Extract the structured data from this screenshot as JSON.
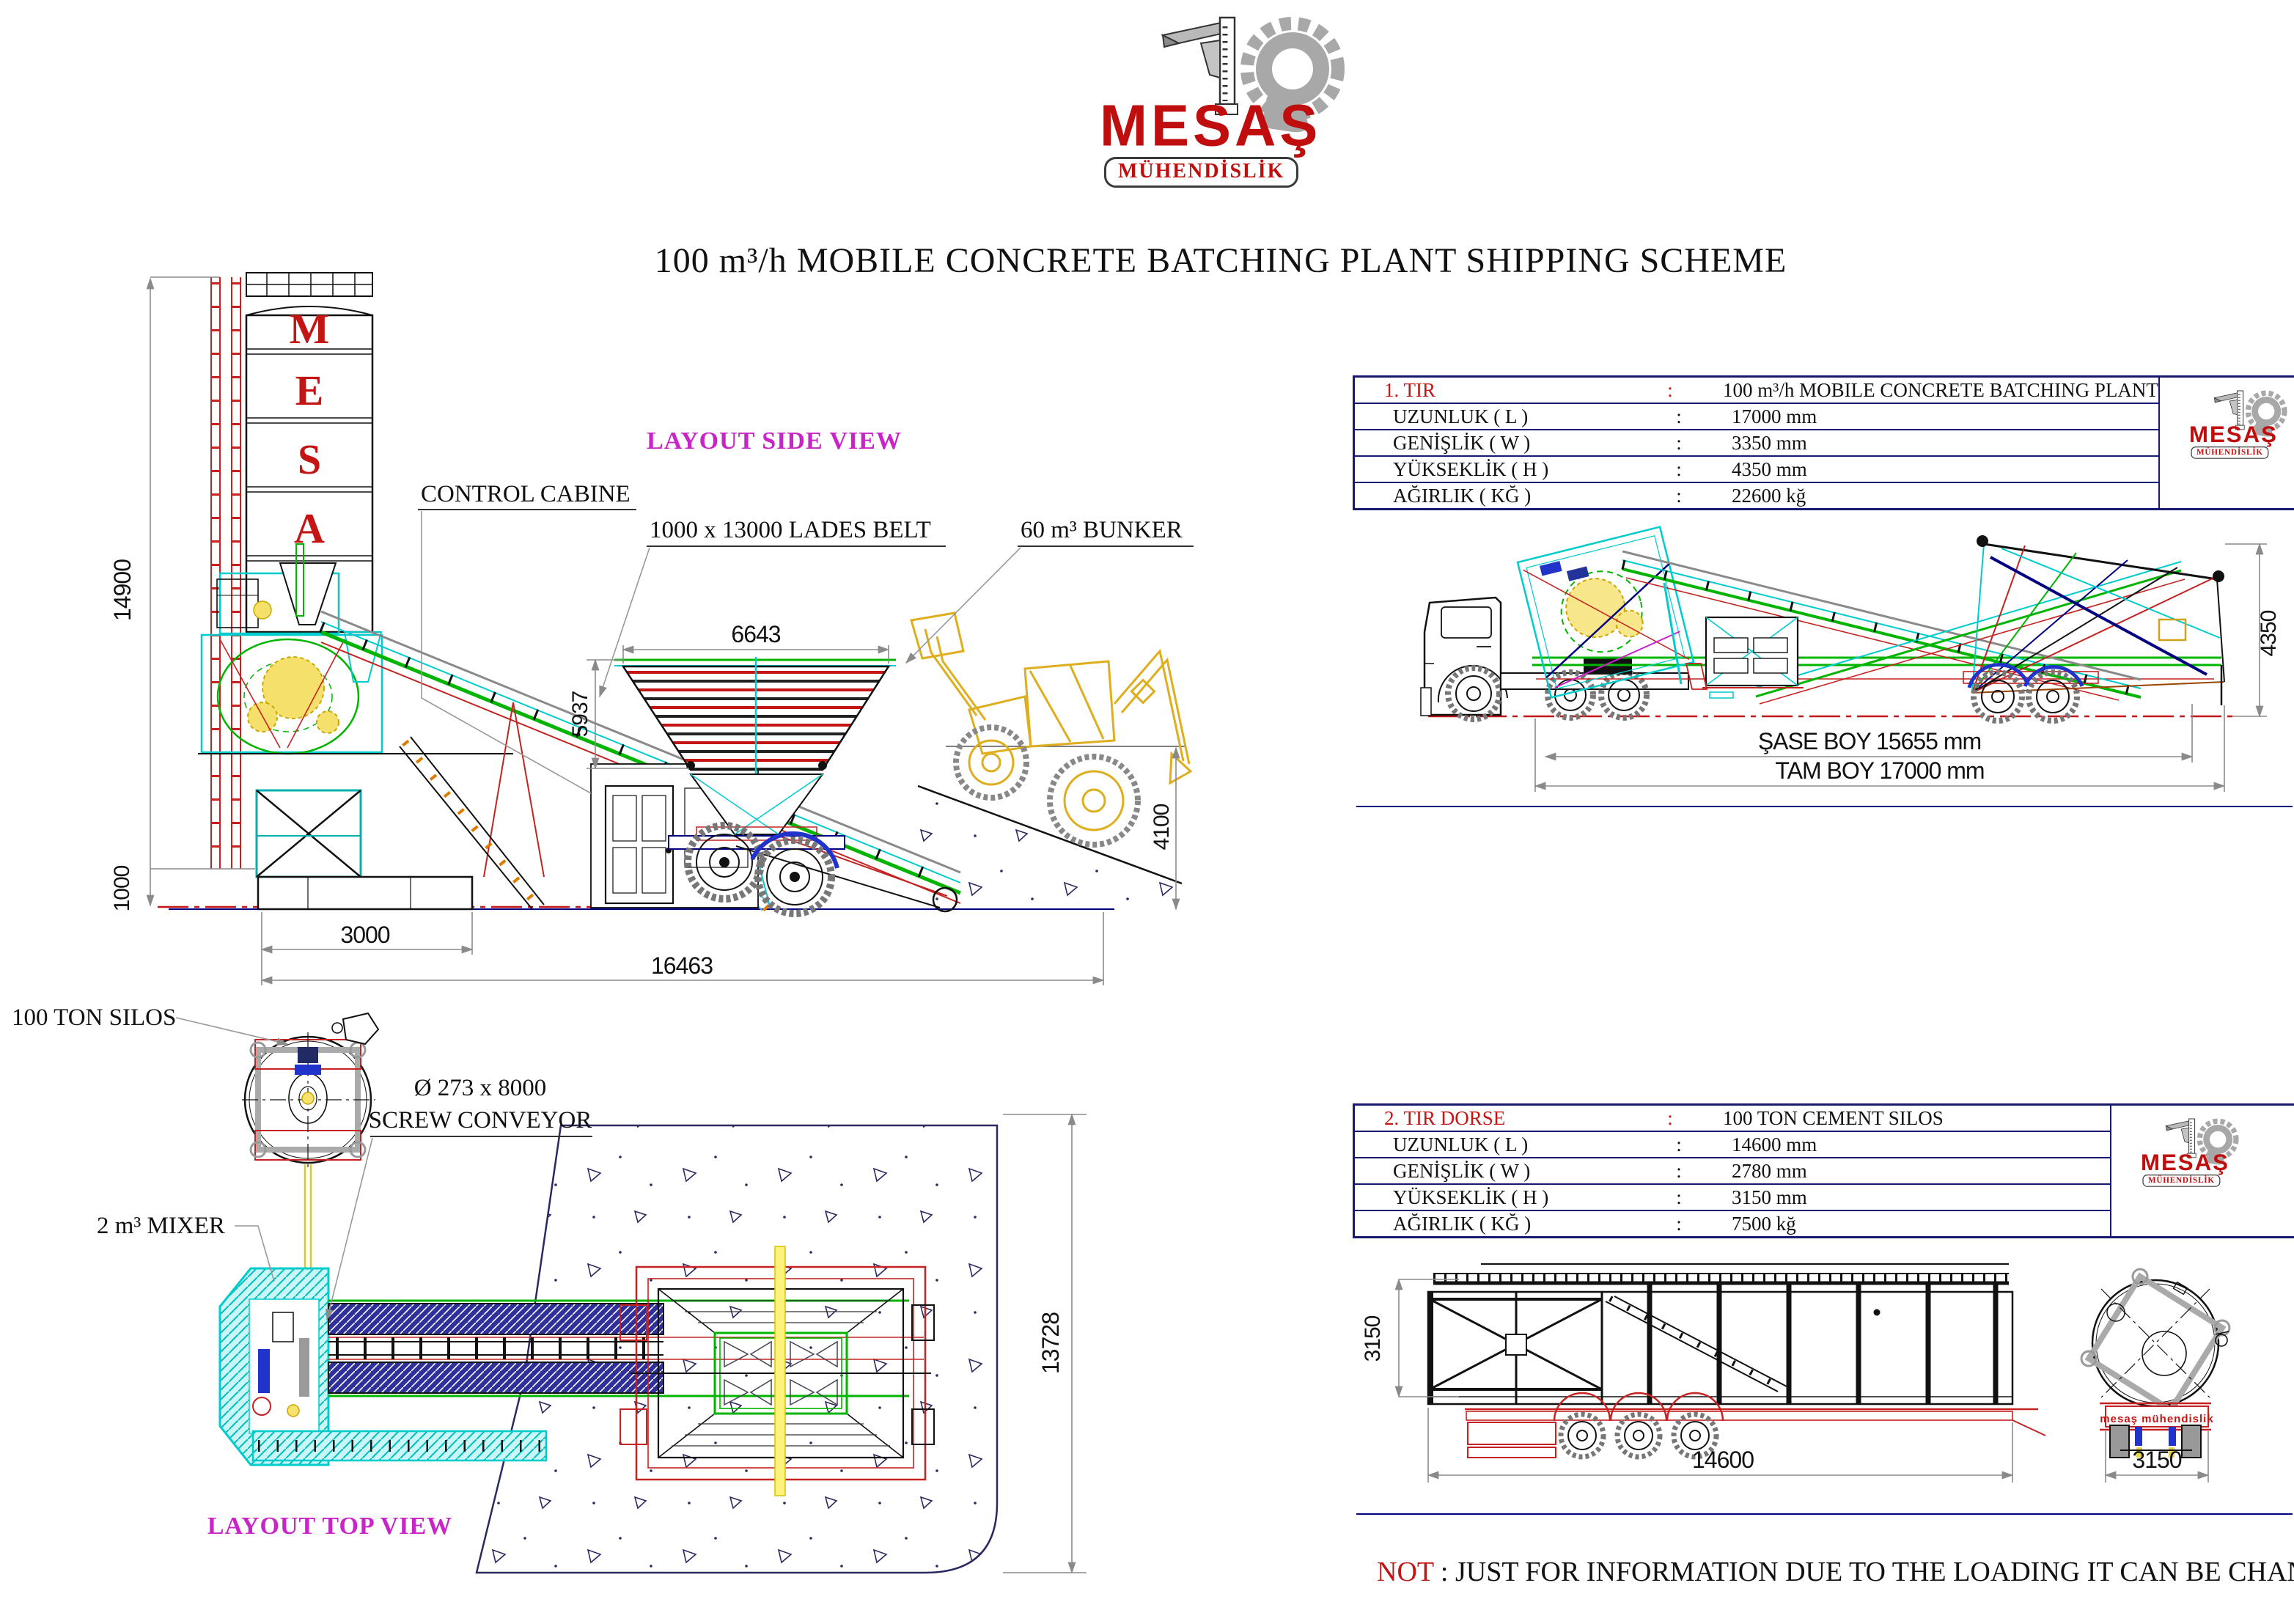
{
  "logo": {
    "brand": "MESAŞ",
    "subtitle": "MÜHENDİSLİK"
  },
  "title": "100 m³/h MOBILE CONCRETE BATCHING PLANT SHIPPING SCHEME",
  "side_view": {
    "caption": "LAYOUT SIDE VIEW",
    "silo_letters": [
      "M",
      "E",
      "S",
      "A",
      "Ş"
    ],
    "labels": {
      "control_cabin": "CONTROL CABINE",
      "lades_belt": "1000 x 13000 LADES BELT",
      "bunker": "60 m³ BUNKER"
    },
    "dims": {
      "total_height": "14900",
      "base_height": "1000",
      "base_width": "3000",
      "total_length": "16463",
      "bunker_width": "6643",
      "bunker_height": "5937",
      "ramp_height": "4100"
    }
  },
  "top_view": {
    "caption": "LAYOUT TOP VIEW",
    "labels": {
      "silos": "100 TON SILOS",
      "screw_line1": "Ø 273 x 8000",
      "screw_line2": "SCREW CONVEYOR",
      "mixer": "2 m³ MIXER"
    },
    "dims": {
      "pad_length": "13728"
    }
  },
  "truck1": {
    "table": {
      "rows": [
        {
          "label": "1. TIR",
          "colon": ":",
          "value": "100 m³/h MOBILE CONCRETE BATCHING PLANT"
        },
        {
          "label": "UZUNLUK ( L )",
          "colon": ":",
          "value": "17000 mm"
        },
        {
          "label": "GENİŞLİK ( W )",
          "colon": ":",
          "value": "3350 mm"
        },
        {
          "label": "YÜKSEKLİK ( H )",
          "colon": ":",
          "value": "4350 mm"
        },
        {
          "label": "AĞIRLIK ( KĞ )",
          "colon": ":",
          "value": "22600 kğ"
        }
      ]
    },
    "dims": {
      "chassis_length": "ŞASE BOY 15655 mm",
      "total_length": "TAM BOY 17000 mm",
      "height": "4350"
    }
  },
  "truck2": {
    "table": {
      "rows": [
        {
          "label": "2. TIR DORSE",
          "colon": ":",
          "value": "100 TON CEMENT SILOS"
        },
        {
          "label": "UZUNLUK ( L )",
          "colon": ":",
          "value": "14600 mm"
        },
        {
          "label": "GENİŞLİK ( W )",
          "colon": ":",
          "value": "2780 mm"
        },
        {
          "label": "YÜKSEKLİK ( H )",
          "colon": ":",
          "value": "3150 mm"
        },
        {
          "label": "AĞIRLIK ( KĞ )",
          "colon": ":",
          "value": "7500 kğ"
        }
      ]
    },
    "dims": {
      "length": "14600",
      "height": "3150",
      "width": "3150"
    },
    "plate": "mesaş mühendislik"
  },
  "note": {
    "prefix": "NOT",
    "body": " : JUST FOR INFORMATION DUE TO THE LOADING IT CAN BE CHANGE."
  },
  "colors": {
    "accent_red": "#c51414",
    "magenta": "#c824c8",
    "navy": "#000080",
    "cyan": "#00cccc",
    "green": "#00b400",
    "yellow": "#e8c000"
  }
}
